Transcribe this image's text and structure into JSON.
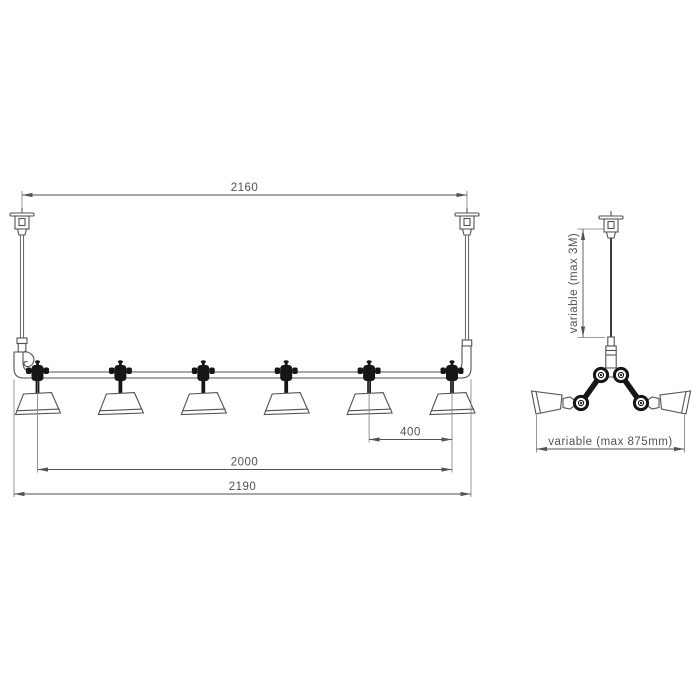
{
  "front_view": {
    "dim_canopy_distance": "2160",
    "dim_shade_spacing": "400",
    "dim_first_to_last_shade": "2000",
    "dim_total_length": "2190"
  },
  "side_view": {
    "dim_suspension_height": "variable (max 3M)",
    "dim_arm_spread": "variable (max 875mm)"
  },
  "style": {
    "background": "#ffffff",
    "line_color": "#515254",
    "dark_part_color": "#161616",
    "text_color": "#515254"
  }
}
